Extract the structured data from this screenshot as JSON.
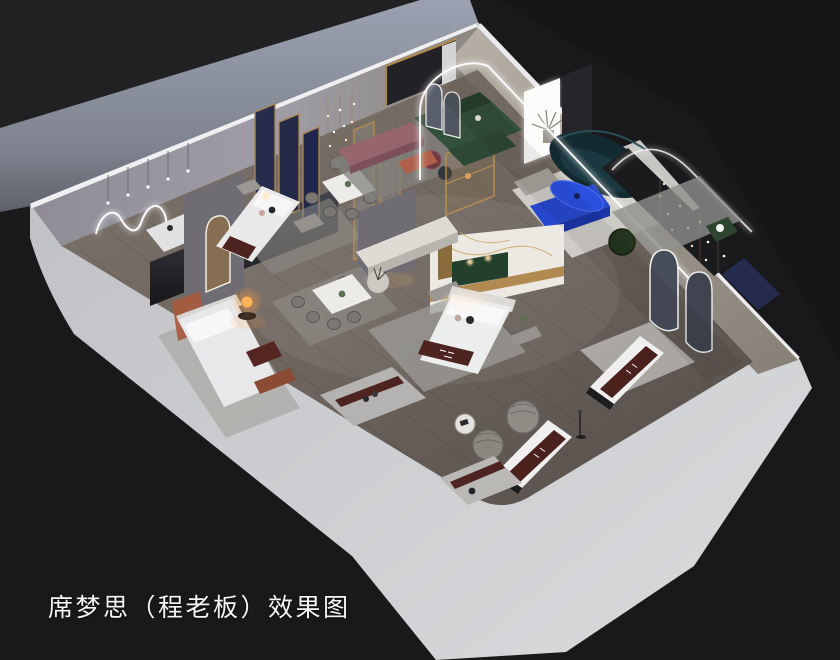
{
  "caption": {
    "text": "席梦思（程老板）效果图"
  },
  "scene": {
    "type": "3d-isometric-interior-render",
    "subject": "mattress-showroom-cutaway-floorplan",
    "areas": [
      "back-left-room-neon-wall",
      "bedroom-display-left",
      "bedroom-display-upper",
      "bedroom-display-center",
      "dining-display-upper",
      "dining-display-lower",
      "lounge-display",
      "master-display-right",
      "mattress-display-row"
    ]
  },
  "palette": {
    "background": "#19191b",
    "exterior_ground": "#9aa0af",
    "outer_wall": "#cbccce",
    "wall_edge_highlight": "#ededef",
    "interior_wall_nw": "#9a96a0",
    "interior_wall_ne": "#aaa49a",
    "floor_wood": "#6e655e",
    "rug_light": "#b7b5b1",
    "accent_blue": "#2b50e0",
    "sofa_green": "#32503a",
    "sofa_teal": "#132a30",
    "runner_maroon": "#4e2420",
    "frame_gold": "#b08a50",
    "panel_navy": "#272c4c",
    "lamp_amber": "#ffb257",
    "bench_mauve": "#96656d",
    "accent_rust": "#a85a3c",
    "led_white": "#ffffff",
    "marble": "#ece9e2",
    "caption_color": "#f5f5f5"
  }
}
